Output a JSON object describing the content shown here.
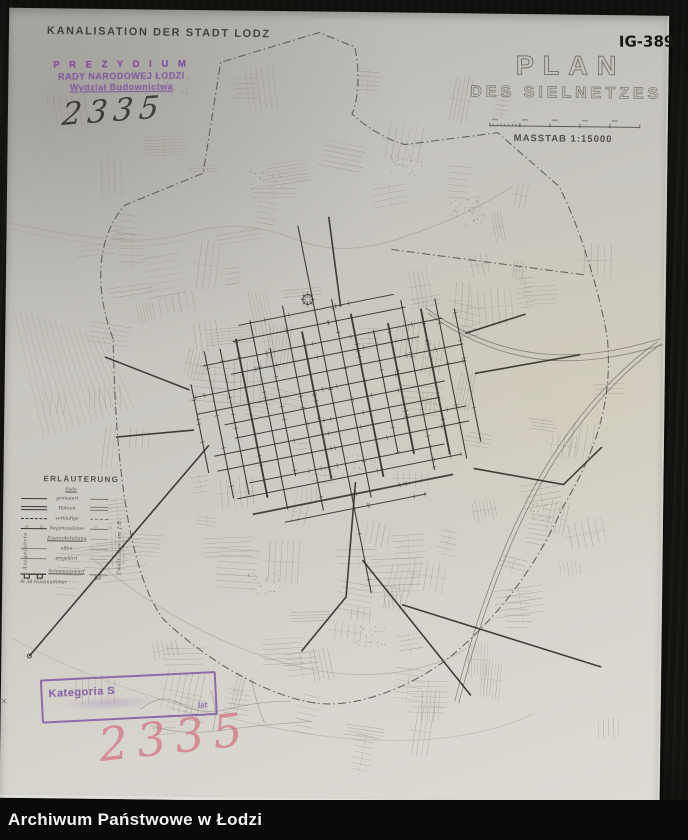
{
  "archive_bar": {
    "label": "Archiwum Państwowe w Łodzi"
  },
  "photo": {
    "header": "KANALISATION DER STADT LODZ",
    "signature": "IG-389",
    "inventory_number_ink": "2335",
    "inventory_number_pink": "2335",
    "title_line1": "PLAN",
    "title_line2": "DES SIELNETZES",
    "scale_label": "MASSTAB 1:15000",
    "stamp_top": {
      "line1": "P R E Z Y D I U M",
      "line2": "RADY NARODOWEJ ŁODZI",
      "line3": "Wydział Budownictwa"
    },
    "stamp_bottom": {
      "word1": "Kategoria S",
      "word2": "lat"
    },
    "legend": {
      "title": "ERLÄUTERUNG",
      "column_header": "Siele",
      "left_vertical": "Ausgeführte",
      "right_vertical": "Zweit. Ber. im J.B.",
      "rows": [
        "gemauert",
        "Röhren",
        "vorläufige",
        "Regenauslässe",
        "Eisenrohrleitung",
        "offen",
        "projektirt"
      ],
      "row_snow": "Schneeauswurf",
      "row_house": "№ 38  Hausnummer"
    },
    "colors": {
      "stamp_purple": "#7d51a0",
      "crayon_pink": "#d4727f",
      "paper": "#cecbc5",
      "background": "#171613",
      "map_dark_ink": "#34332d",
      "map_faint_ink": "#8d8b82"
    }
  }
}
